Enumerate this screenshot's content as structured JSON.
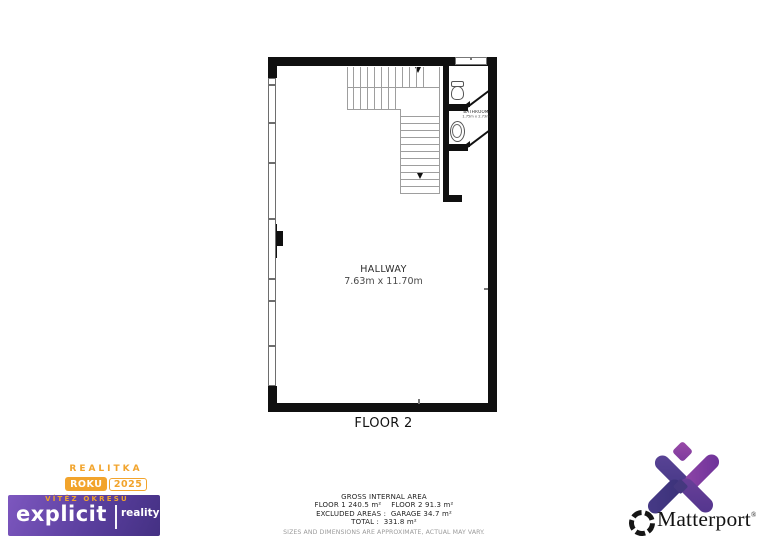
{
  "plan": {
    "floor_label": "FLOOR 2",
    "rooms": {
      "hallway": {
        "name": "HALLWAY",
        "dims": "7.63m x 11.70m"
      },
      "bathroom": {
        "name": "BATHROOM",
        "dims": "1.75m x 2.73m"
      }
    }
  },
  "area_summary": {
    "title": "GROSS INTERNAL AREA",
    "floor1": "FLOOR 1 240.5 m²",
    "floor2": "FLOOR 2 91.3 m²",
    "excluded": "EXCLUDED AREAS :  GARAGE 34.7 m²",
    "total": "TOTAL :  331.8 m²",
    "disclaimer": "SIZES AND DIMENSIONS ARE APPROXIMATE, ACTUAL MAY VARY."
  },
  "agency_badge": {
    "award_title": "REALITKA",
    "award_tag_year_label": "ROKU",
    "award_tag_year": "2025",
    "award_subtitle": "VÍTĚZ OKRESU",
    "brand_name": "explicit",
    "brand_division": "reality",
    "accent_orange": "#F2A42C",
    "gradient_start": "#7D57BF",
    "gradient_end": "#443083"
  },
  "matterport_logo": {
    "wordmark": "Matterport",
    "registered_mark": "®",
    "brand_purple": "#6B3FA0"
  }
}
